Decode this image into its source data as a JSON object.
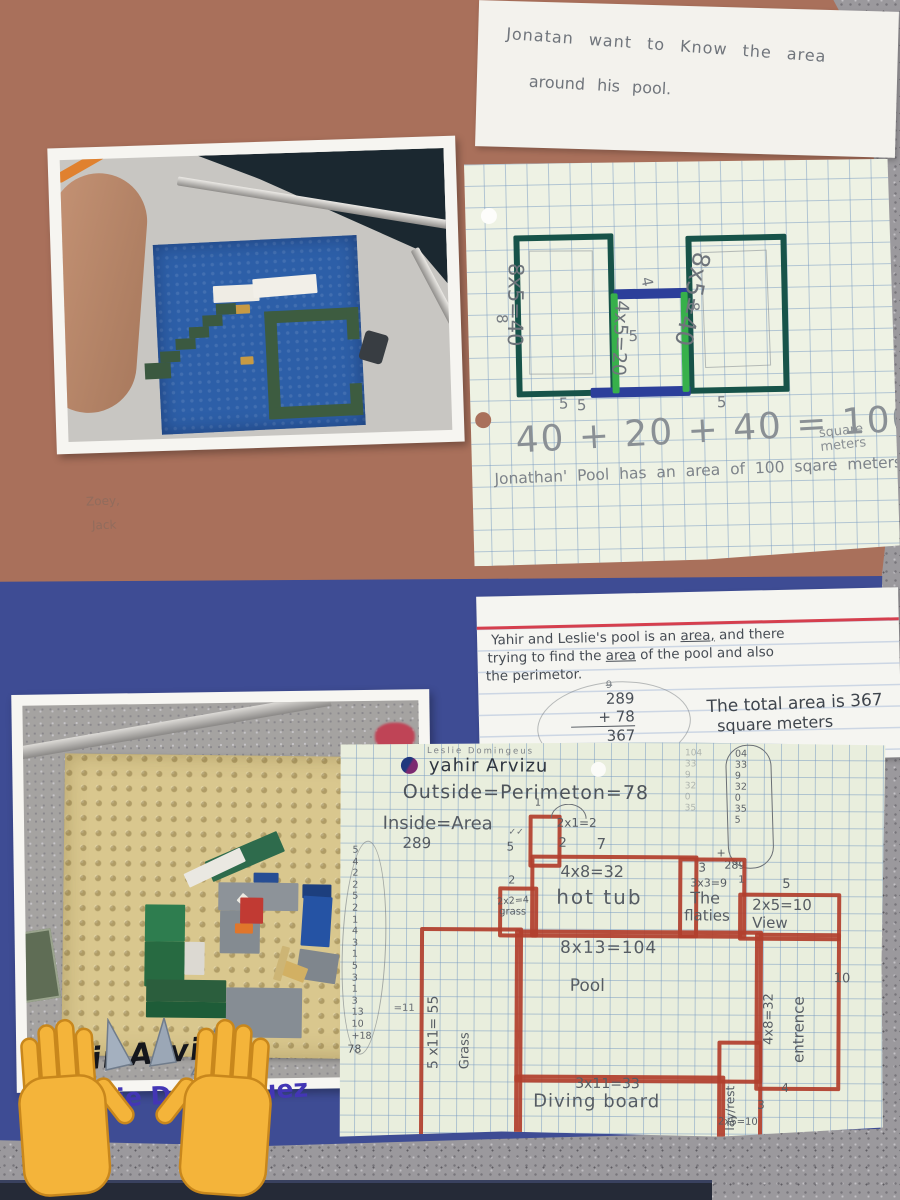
{
  "scene": {
    "type": "photograph",
    "description": "Two classroom posters on a gray speckled desk: LEGO pool models with hand-drawn grid-paper area and perimeter worksheets."
  },
  "top_poster": {
    "note": {
      "line1": "Jonatan want to Know the area",
      "line2": "around his pool."
    },
    "worksheet": {
      "left_area": "8x5=40",
      "middle_area": "4x5=20",
      "right_area": "8x5=40",
      "dim_left_8": "8",
      "dim_left_5": "5",
      "dim_mid_4": "4",
      "dim_mid_5": "5",
      "dim_right_8": "8",
      "dim_right_5": "5",
      "dim_bottom_left_5": "5",
      "equation": "40 + 20 + 40 = 100",
      "unit_line1": "square",
      "unit_line2": "meters",
      "conclusion": "Jonathan' Pool has an area of 100 sqare meters."
    },
    "faint_name1": "Zoey,",
    "faint_name2": "Jack"
  },
  "bottom_poster": {
    "note": {
      "line1a": "Yahir and Leslie's pool is an ",
      "line1b": "area,",
      "line1c": " and there",
      "line2a": "trying to find the ",
      "line2b": "area",
      "line2c": " of the pool and also",
      "line3": "the perimetor.",
      "carry": "9",
      "add_row1": "289",
      "add_row2": "+ 78",
      "add_result": "367",
      "total_line1": "The total area is 367",
      "total_line2": "square meters"
    },
    "worksheet": {
      "header_small": "Leslie Domingeus",
      "student_name": "yahir Arvizu",
      "perimeter_line": "Outside=Perimeton=78",
      "area_label": "Inside=Area",
      "area_value": "289",
      "left_column": "5\n4\n2\n2\n5\n2\n1\n4\n3\n1\n5\n3\n1\n3\n13\n10\n+18",
      "left_total": "78",
      "left_note": "=11",
      "ghost_column": "104\n33\n9\n32\n0\n35",
      "pencil_column": "04\n33\n9\n32\n0\n35\n5",
      "column_plus": "+",
      "column_sum": "289",
      "regions": {
        "tiny": {
          "top1": "1",
          "eq": "2x1=2",
          "right2": "2",
          "left5": "5",
          "check": "✓✓"
        },
        "hot_tub": {
          "top7": "7",
          "eq": "4x8=32",
          "name": "hot tub"
        },
        "grass_small": {
          "top2": "2",
          "eq": "2x2=4",
          "name": "grass"
        },
        "flaties": {
          "top3": "3",
          "eq": "3x3=9",
          "right1": "1",
          "name1": "The",
          "name2": "flaties"
        },
        "view": {
          "top5": "5",
          "eq": "2x5=10",
          "name": "View"
        },
        "pool": {
          "eq": "8x13=104",
          "name": "Pool"
        },
        "grass_big": {
          "eq": "5 x11= 55",
          "name": "Grass"
        },
        "diving_board": {
          "eq": "3x11=33",
          "name": "Diving board",
          "bottom": "13"
        },
        "entrance": {
          "eq": "4x8=32",
          "name": "entrence",
          "right10": "10",
          "bottom4": "4"
        },
        "lay_rest": {
          "name": "lay/rest",
          "eq": "2x5=10",
          "right3": "3"
        }
      }
    },
    "signature1": "Yahir Arvizu",
    "signature2": "Leslie Dominguez",
    "emoji": "raised-hands"
  }
}
